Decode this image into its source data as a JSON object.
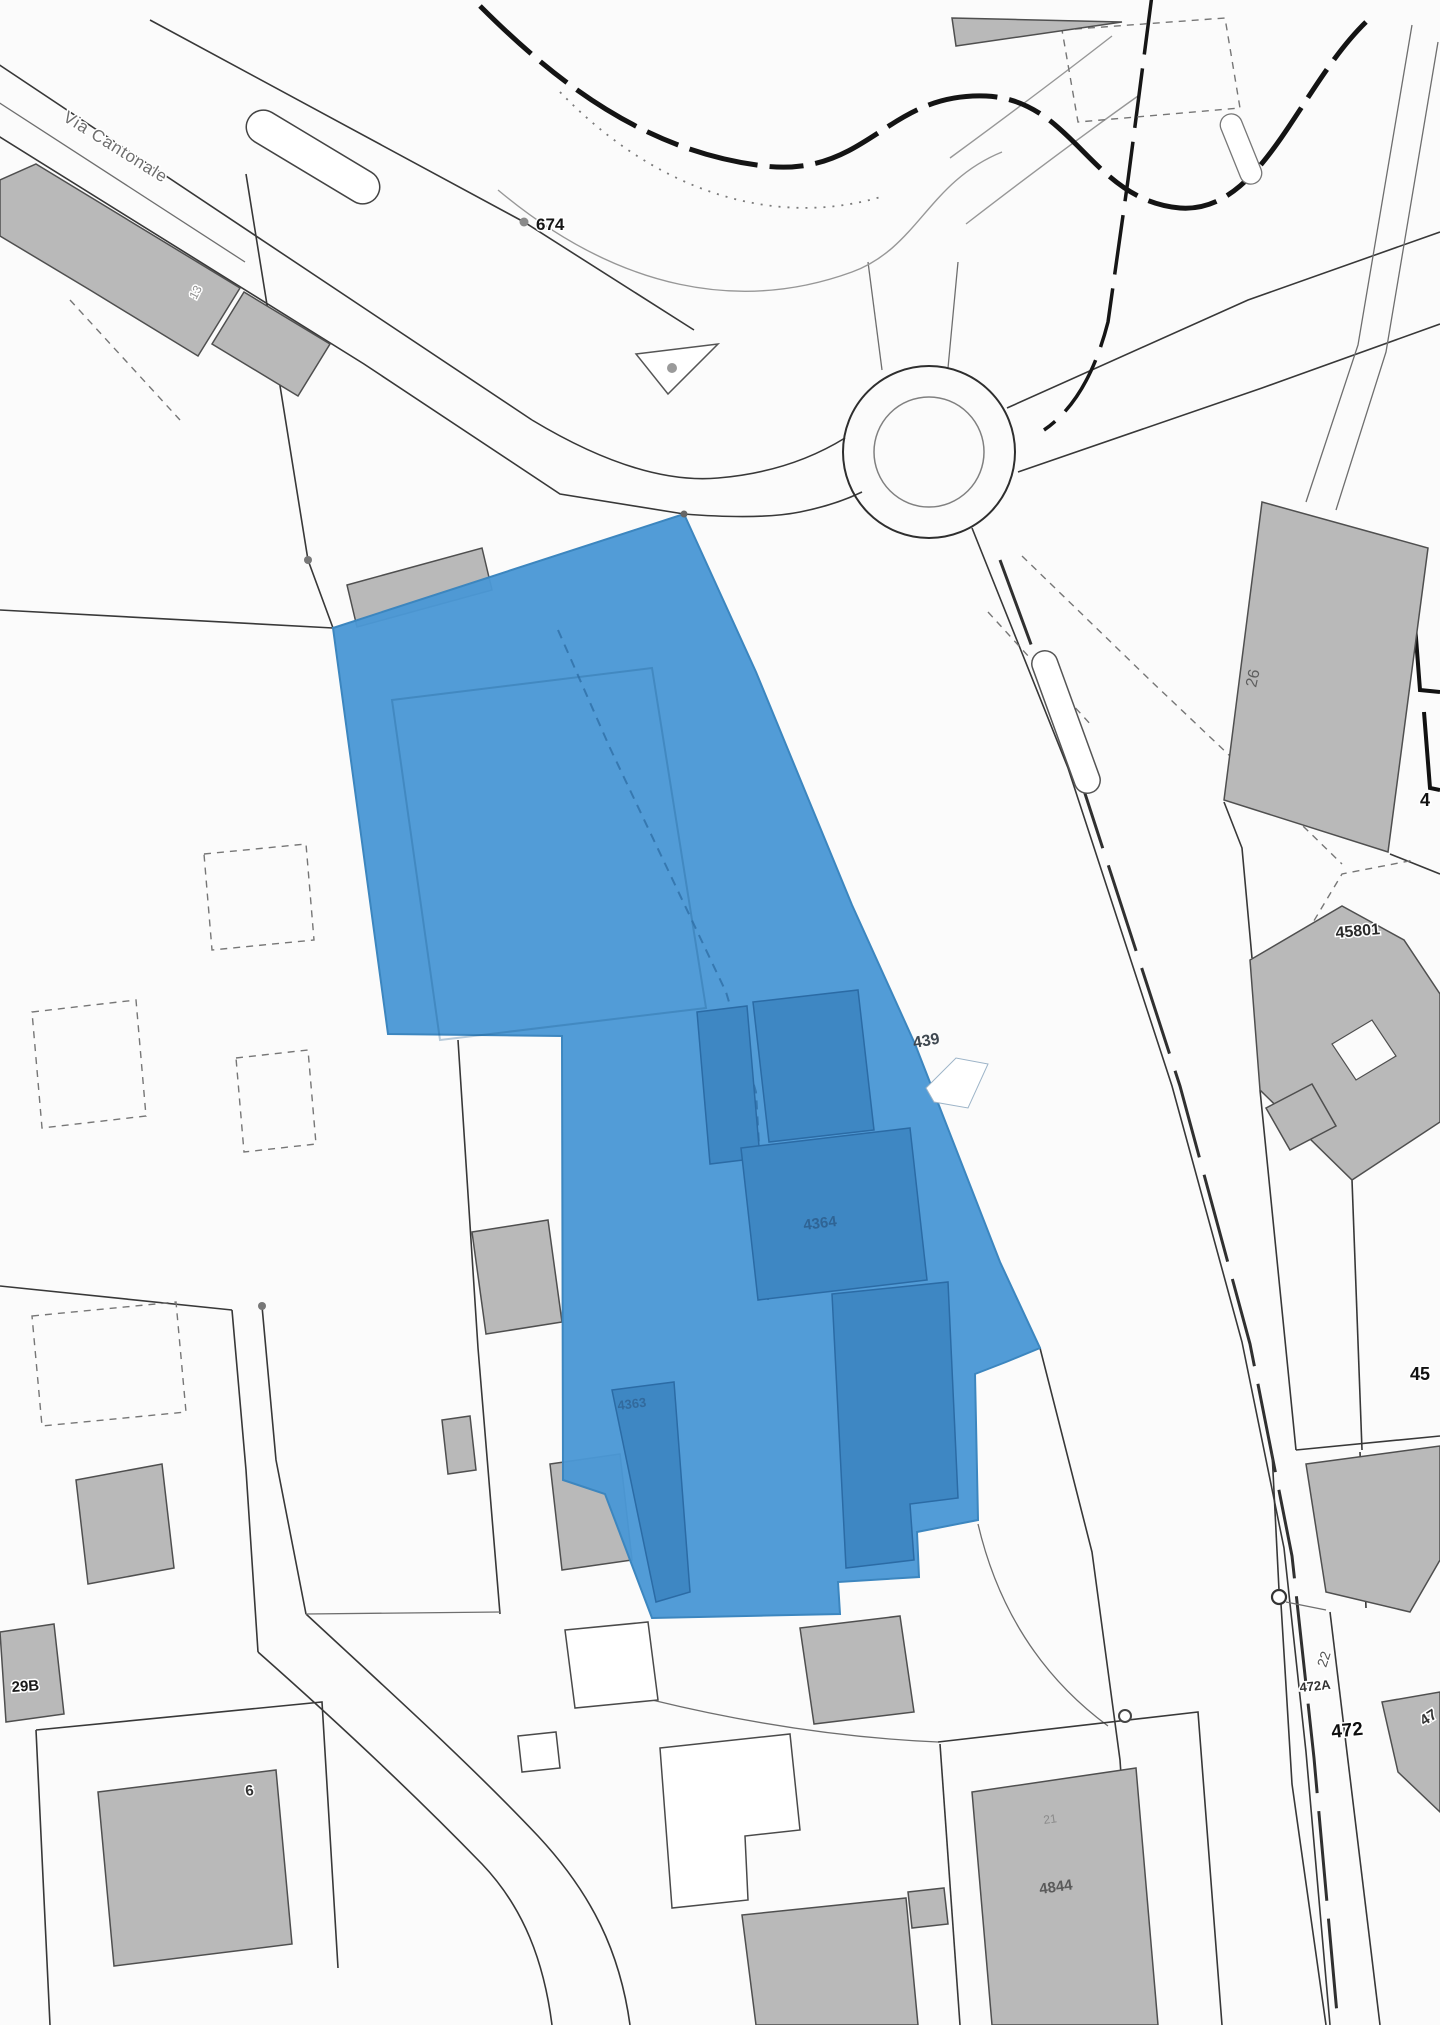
{
  "map": {
    "kind": "cadastral-plan",
    "highlight_color": "#4b98d5",
    "labels": {
      "via_cantonale": "Via Cantonale",
      "pt_674": "674",
      "b_13": "13",
      "p_439": "439",
      "p_4364": "4364",
      "p_4363": "4363",
      "p_26": "26",
      "p_45801": "45801",
      "edge_4": "4",
      "edge_45": "45",
      "p_22": "22",
      "p_472a": "472A",
      "p_472": "472",
      "edge_47": "47",
      "p_29b": "29B",
      "p_6": "6",
      "p_21": "21",
      "p_4844": "4844"
    }
  }
}
